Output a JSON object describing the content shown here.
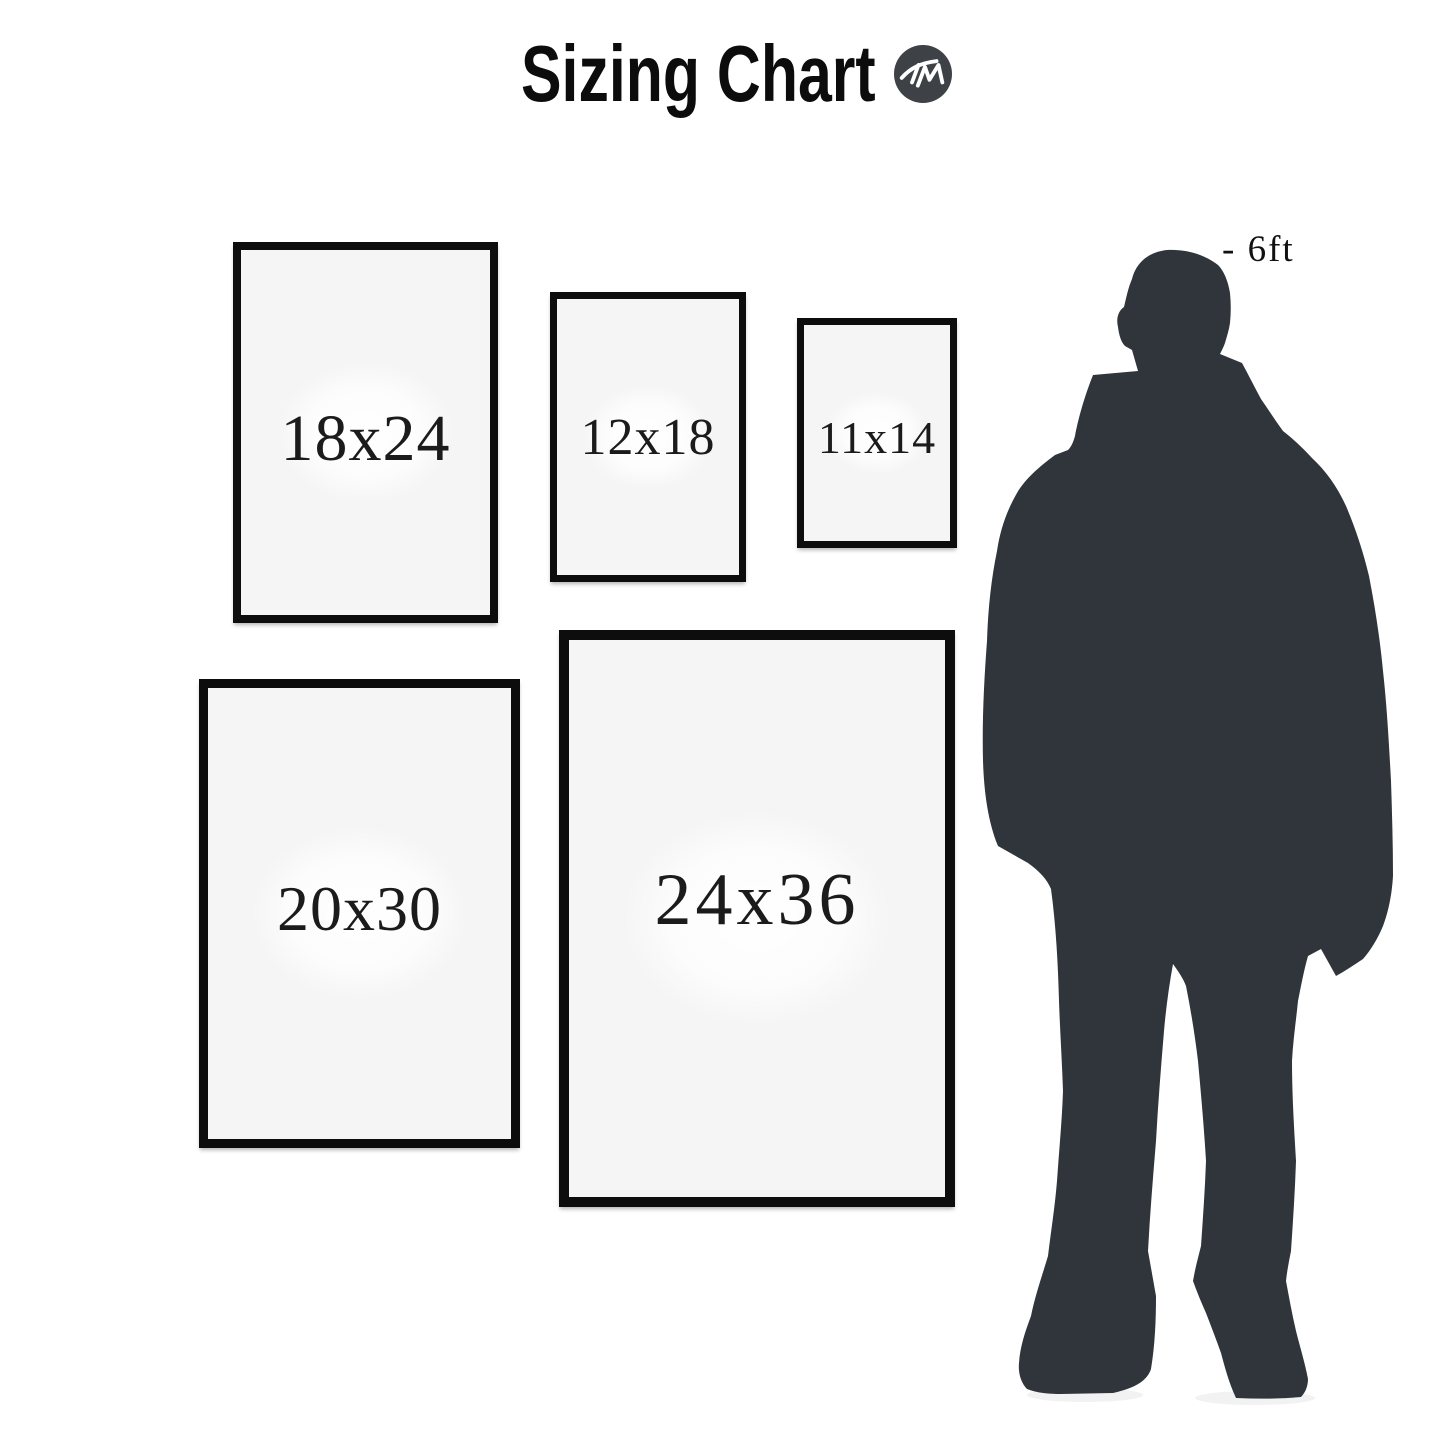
{
  "title": "Sizing Chart",
  "logo": {
    "text": "TM"
  },
  "height_marker": "- 6ft",
  "frames": [
    {
      "label": "18x24"
    },
    {
      "label": "12x18"
    },
    {
      "label": "11x14"
    },
    {
      "label": "20x30"
    },
    {
      "label": "24x36"
    }
  ],
  "chart_data": {
    "type": "table",
    "title": "Sizing Chart",
    "categories": [
      "18x24",
      "12x18",
      "11x14",
      "20x30",
      "24x36"
    ],
    "values_inches": [
      [
        18,
        24
      ],
      [
        12,
        18
      ],
      [
        11,
        14
      ],
      [
        20,
        30
      ],
      [
        24,
        36
      ]
    ],
    "reference": "- 6ft person silhouette"
  },
  "colors": {
    "background": "#ffffff",
    "frame_border": "#0d0d0d",
    "frame_interior": "#f5f5f6",
    "label_text": "#1b1b1b",
    "silhouette": "#2f353a",
    "logo_circle": "#3e4247",
    "logo_mark": "#ffffff"
  }
}
